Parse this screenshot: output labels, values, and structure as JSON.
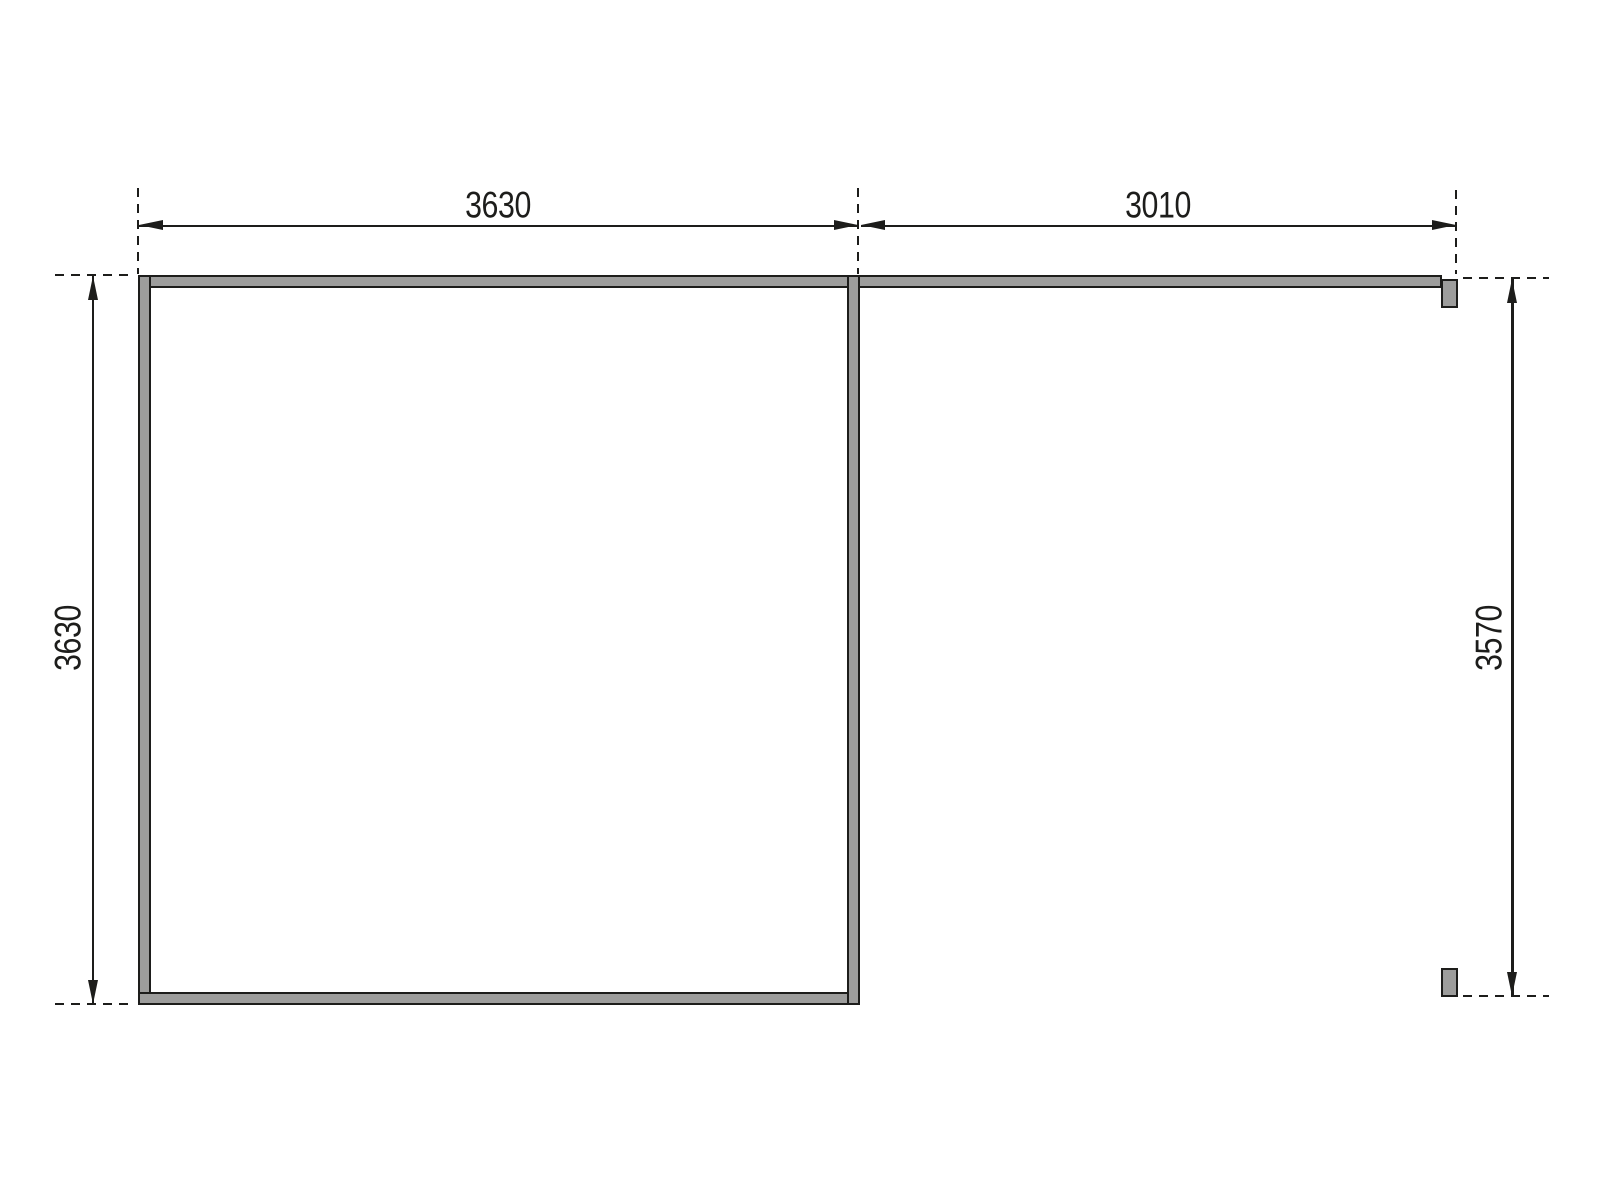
{
  "drawing": {
    "type": "floor-plan-dimension-drawing",
    "colors": {
      "line": "#1d1d1b",
      "wall_fill": "#9d9d9c",
      "background": "#ffffff"
    },
    "dimensions": {
      "top_left_width": "3630",
      "top_right_width": "3010",
      "left_height": "3630",
      "right_height": "3570"
    }
  }
}
